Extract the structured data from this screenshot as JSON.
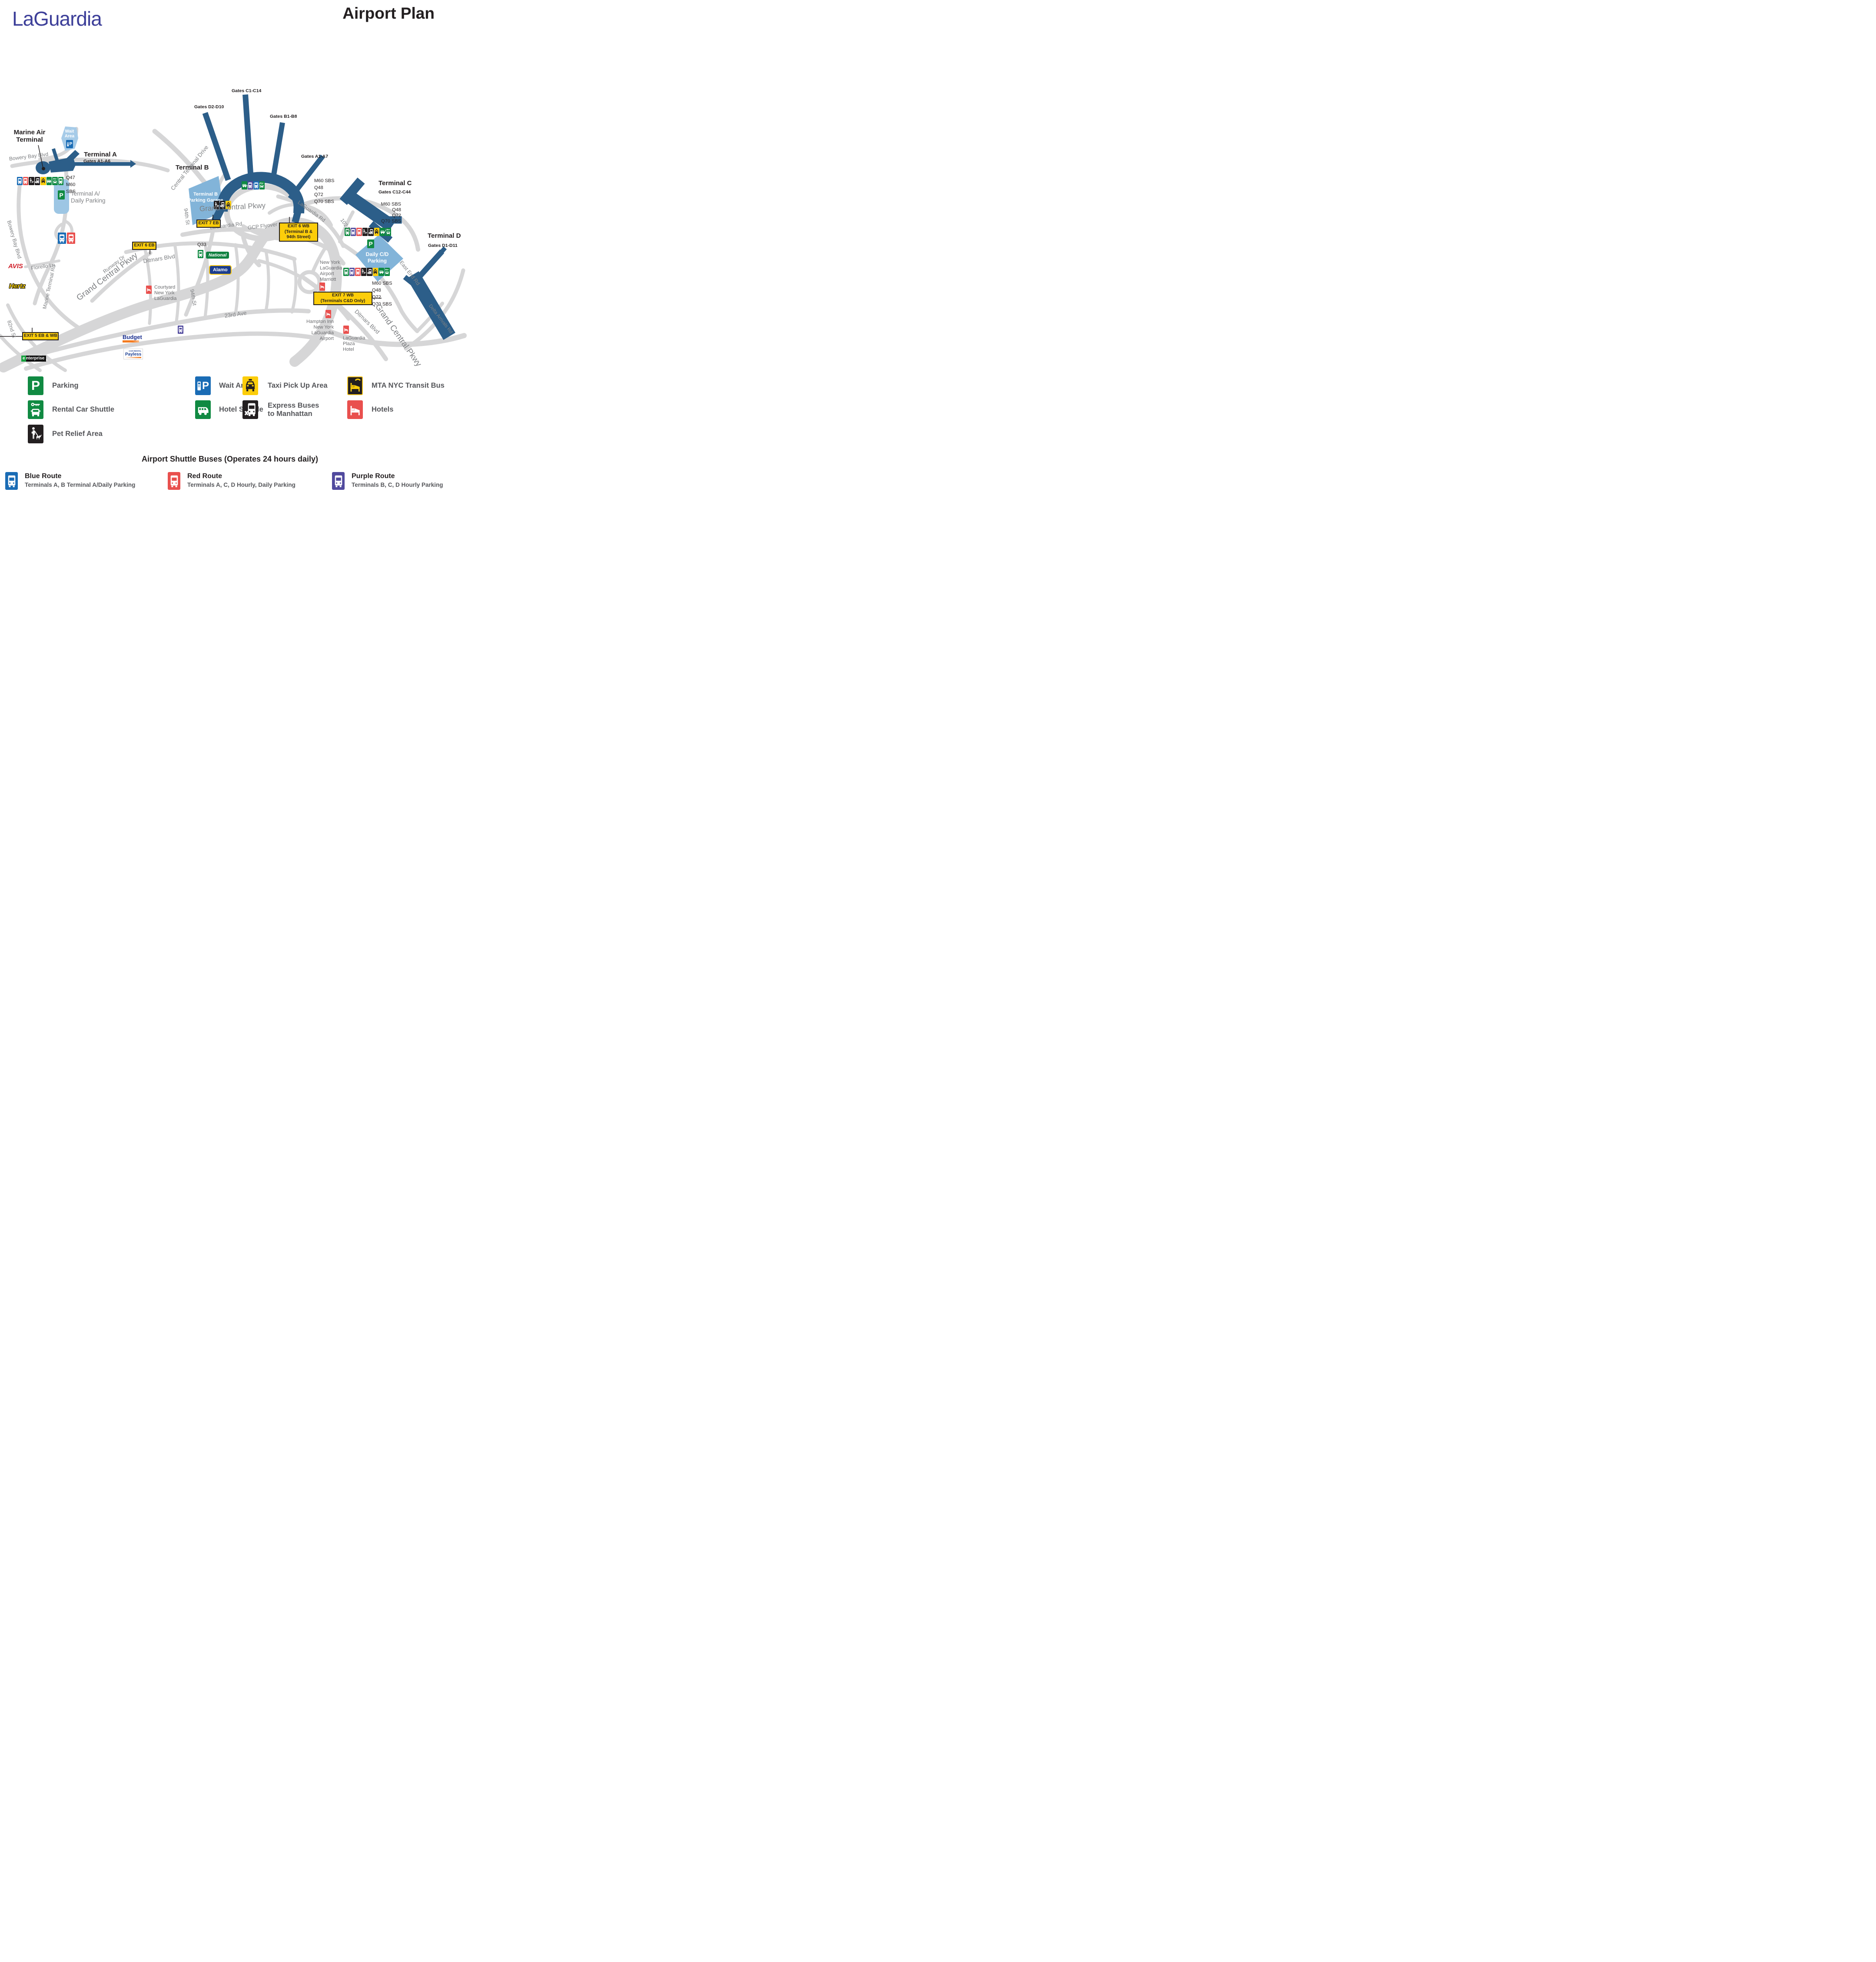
{
  "header": {
    "logo": "LaGuardia",
    "title": "Airport Plan"
  },
  "terminals": {
    "marine_air": {
      "name": "Marine Air Terminal"
    },
    "a": {
      "name": "Terminal A",
      "gates": "Gates A1-A6",
      "routes": [
        "Q47",
        "M60",
        "SBS"
      ]
    },
    "b": {
      "name": "Terminal B",
      "gate_labels": [
        "Gates D2-D10",
        "Gates C1-C14",
        "Gates B1-B8",
        "Gates A1-A7"
      ],
      "routes": [
        "M60 SBS",
        "Q48",
        "Q72",
        "Q70 SBS"
      ]
    },
    "c": {
      "name": "Terminal C",
      "gates": "Gates C12-C44",
      "routes": [
        "M60 SBS",
        "Q48",
        "Q72",
        "Q70 SBS"
      ]
    },
    "d": {
      "name": "Terminal D",
      "gates": "Gates D1-D11",
      "routes": [
        "M60 SBS",
        "Q48",
        "Q72",
        "Q70 SBS"
      ]
    }
  },
  "parking": {
    "wait_line1": "Wait",
    "wait_line2": "Area",
    "ta_line1": "Terminal A/",
    "ta_line2": "Daily Parking",
    "garage_line1": "Terminal B",
    "garage_line2": "Parking Garage",
    "daily_line1": "Daily C/D",
    "daily_line2": "Parking"
  },
  "signs": {
    "exit7eb": "EXIT 7 EB",
    "exit6eb": "EXIT 6 EB",
    "exit5": "EXIT 5 EB & WB",
    "exit6wb_1": "EXIT 6 WB",
    "exit6wb_2": "(Terminal B &",
    "exit6wb_3": "94th Street)",
    "exit7wb_1": "EXIT 7 WB",
    "exit7wb_2": "(Terminals C&D Only)"
  },
  "roads": {
    "gcp_main": "Grand Central Pkwy",
    "gcp_sw": "Grand Central Pkwy",
    "gcp_se": "Grand Central Pkwy",
    "gcp_flyover": "GCP Flyover",
    "central_terminal": "Central Terminal Drive",
    "laguardia_rd_1": "LaGuardia Rd",
    "laguardia_rd_2": "LaGuardia Rd",
    "st94_n": "94th St",
    "st94_s": "94th St",
    "ditmars_w": "Ditmars Blvd",
    "ditmars_e": "Ditmars Blvd",
    "ave23": "23rd Ave",
    "bowery_n": "Bowery Bay Blvd",
    "bowery_w": "Bowery Bay Blvd",
    "fiorello": "Fiorello Ln",
    "marine_terminal": "Marine Terminal Rd",
    "runway": "Runway Dr",
    "st82": "82nd St",
    "st102": "102 St",
    "east_end": "East End Rd",
    "delta": "Delta Arrivals Rd"
  },
  "transit": {
    "q33": "Q33"
  },
  "brands": {
    "avis": "AVIS",
    "hertz": "Hertz",
    "enterprise_e": "e",
    "enterprise_rest": "nterprise",
    "national": "National",
    "alamo": "Alamo",
    "budget": "Budget",
    "payless": "Payless",
    "payless_tag": "CAR RENTAL"
  },
  "hotels": {
    "courtyard": [
      "Courtyard",
      "New York",
      "LaGuardia"
    ],
    "marriott": [
      "New York",
      "LaGuardia",
      "Airport",
      "Marriott"
    ],
    "hampton": [
      "Hampton Inn",
      "New York",
      "LaGuardia",
      "Airport"
    ],
    "plaza": [
      "LaGuardia",
      "Plaza",
      "Hotel"
    ]
  },
  "legend": {
    "parking": "Parking",
    "wait_area": "Wait Area",
    "taxi": "Taxi Pick Up Area",
    "mta": "MTA NYC Transit Bus",
    "rental": "Rental Car Shuttle",
    "hotel_shuttle": "Hotel Shuttle",
    "express_1": "Express Buses",
    "express_2": "to Manhattan",
    "hotels": "Hotels",
    "pet": "Pet Relief Area"
  },
  "shuttle": {
    "title": "Airport Shuttle Buses (Operates 24 hours daily)",
    "routes": [
      {
        "name": "Blue Route",
        "desc": "Terminals A, B Terminal A/Daily Parking"
      },
      {
        "name": "Red Route",
        "desc": "Terminals A, C, D Hourly, Daily Parking"
      },
      {
        "name": "Purple Route",
        "desc": "Terminals B, C, D Hourly Parking"
      }
    ]
  },
  "icons": {
    "p_letter": "P",
    "bus": "front-facing shuttle bus pictogram",
    "hotel_shuttle": "side-view minibus pictogram",
    "rental_car": "key above car pictogram",
    "taxi": "taxi cab pictogram",
    "express_bus": "bus with x pictogram",
    "pet_relief": "person walking dog pictogram",
    "hotel": "bed pictogram",
    "wait_area": "phone handset with letter P",
    "mta_bus": "yellow phone and bed on black"
  },
  "colors": {
    "terminal_blue": "#2c5e89",
    "parking_light": "#9dc6e4",
    "parking_mid": "#82b4d9",
    "road_gray": "#d6d6d7",
    "green": "#108a42",
    "purple": "#514a9e",
    "red": "#e9504e",
    "blue": "#1a6cb5",
    "yellow": "#fccd0a",
    "black": "#231f20",
    "logo_blue": "#3d3f99"
  }
}
